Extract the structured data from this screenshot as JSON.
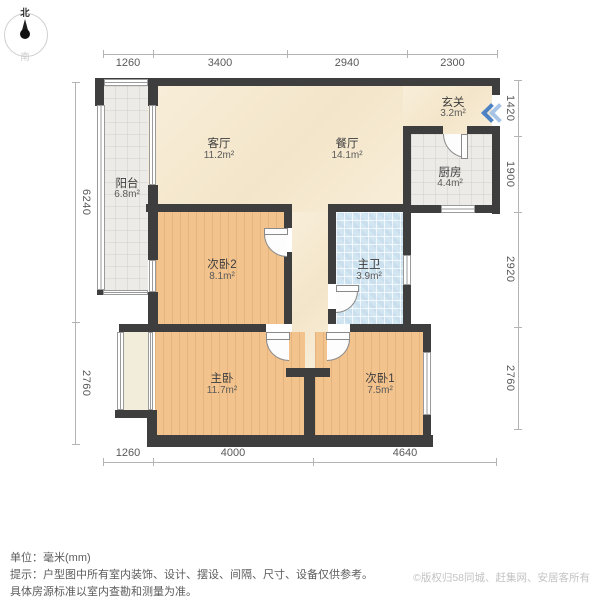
{
  "compass": {
    "north_label": "北",
    "south_label": "南"
  },
  "dimensions": {
    "top": [
      "1260",
      "3400",
      "2940",
      "2300"
    ],
    "bottom": [
      "1260",
      "4000",
      "4640"
    ],
    "left": [
      "6240",
      "2760"
    ],
    "right": [
      "1420",
      "1900",
      "2920",
      "2760"
    ]
  },
  "rooms": [
    {
      "id": "balcony",
      "name": "阳台",
      "area": "6.8m²"
    },
    {
      "id": "living",
      "name": "客厅",
      "area": "11.2m²"
    },
    {
      "id": "dining",
      "name": "餐厅",
      "area": "14.1m²"
    },
    {
      "id": "entry",
      "name": "玄关",
      "area": "3.2m²"
    },
    {
      "id": "kitchen",
      "name": "厨房",
      "area": "4.4m²"
    },
    {
      "id": "bedroom2",
      "name": "次卧2",
      "area": "8.1m²"
    },
    {
      "id": "bathroom",
      "name": "主卫",
      "area": "3.9m²"
    },
    {
      "id": "master",
      "name": "主卧",
      "area": "11.7m²"
    },
    {
      "id": "bedroom1",
      "name": "次卧1",
      "area": "7.5m²"
    }
  ],
  "footer": {
    "unit_line": "单位：毫米(mm)",
    "note_line1": "提示：户型图中所有室内装饰、设计、摆设、间隔、尺寸、设备仅供参考。",
    "note_line2": "具体房源标准以室内查勘和测量为准。",
    "copyright": "©版权归58同城、赶集网、安居客所有"
  },
  "colors": {
    "wall": "#3e3e3e",
    "wood_floor": "#f3c38e",
    "public_floor": "#f7ead2",
    "tile_floor": "#ecebe7",
    "bath_floor": "#d2e6f2",
    "entry_arrow_front": "#4d82c4",
    "entry_arrow_back": "#a7c4e6"
  }
}
